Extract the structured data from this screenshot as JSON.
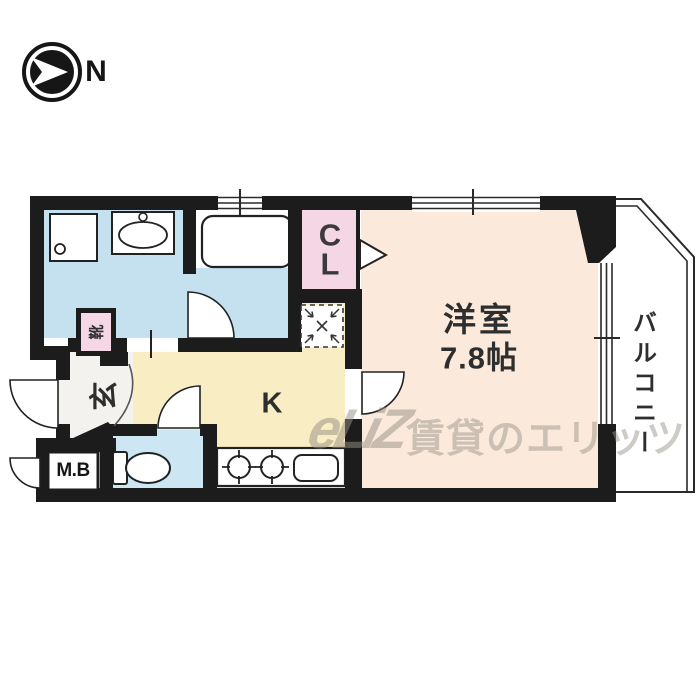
{
  "compass": {
    "label": "N"
  },
  "rooms": {
    "western_room": {
      "name": "洋室",
      "size": "7.8帖"
    },
    "kitchen": {
      "label": "K"
    },
    "closet": {
      "label": "CL"
    },
    "entrance": {
      "label": "玄"
    },
    "shoe_cabinet": {
      "label": "靴"
    },
    "meter_box": {
      "label": "M.B"
    },
    "balcony": {
      "label": "バルコニー"
    }
  },
  "watermark": {
    "logo": "eLiZ",
    "text": "賃貸のエリッツ"
  },
  "fixtures": [
    "compass-north",
    "washing-machine-pan",
    "washbasin",
    "bathtub",
    "bath-door",
    "closet-folding-door",
    "refrigerator-space",
    "toilet",
    "toilet-door",
    "gas-stove-2-burner",
    "kitchen-sink",
    "entrance-door",
    "meter-box-door",
    "room-door",
    "windows"
  ],
  "colors": {
    "wall": "#1c1c1c",
    "washroom_floor": "#c5e1ef",
    "bath_floor": "#c5e1ef",
    "toilet_floor": "#cde6f3",
    "kitchen_floor": "#f8edc3",
    "western_room_floor": "#fbeadc",
    "closet_fill": "#f5d6e5",
    "shoe_box_fill": "#f5d6e5",
    "entrance_floor": "#f3f2ef",
    "balcony_fill": "#ffffff",
    "watermark_gray": "#99918a"
  }
}
